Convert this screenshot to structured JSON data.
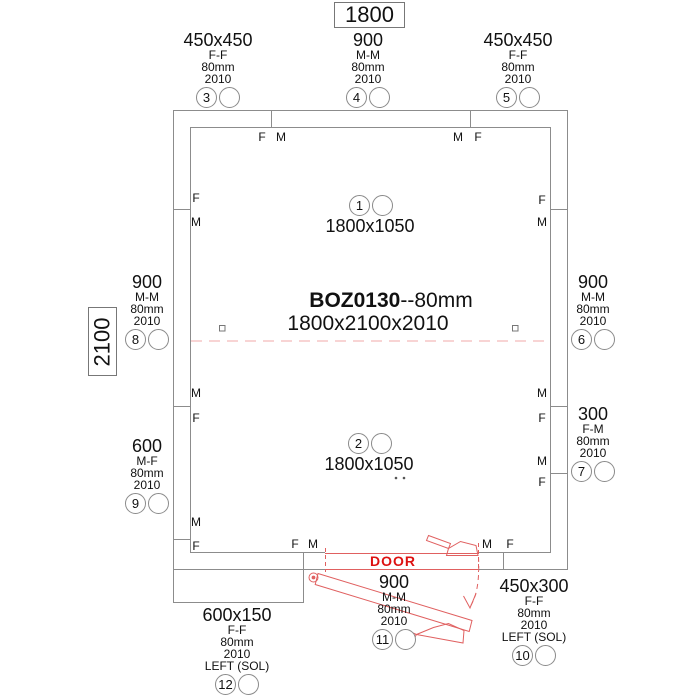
{
  "colors": {
    "line_gray": "#8c8c8c",
    "door_red": "#e06060",
    "door_text_red": "#dd1111",
    "ceiling_joint_pink": "#f2a8a8"
  },
  "title": {
    "model": "BOZ0130",
    "suffix": "--80mm",
    "box_dimensions": "1800x2100x2010"
  },
  "overall_dimensions": {
    "width": "1800",
    "height": "2100"
  },
  "door": {
    "label": "DOOR"
  },
  "ceiling_panels": [
    {
      "num": "1",
      "size": "1800x1050"
    },
    {
      "num": "2",
      "size": "1800x1050"
    }
  ],
  "panels": {
    "p3": {
      "num": "3",
      "size": "450x450",
      "joint": "F-F",
      "thickness": "80mm",
      "height": "2010"
    },
    "p4": {
      "num": "4",
      "size": "900",
      "joint": "M-M",
      "thickness": "80mm",
      "height": "2010"
    },
    "p5": {
      "num": "5",
      "size": "450x450",
      "joint": "F-F",
      "thickness": "80mm",
      "height": "2010"
    },
    "p6": {
      "num": "6",
      "size": "900",
      "joint": "M-M",
      "thickness": "80mm",
      "height": "2010"
    },
    "p7": {
      "num": "7",
      "size": "300",
      "joint": "F-M",
      "thickness": "80mm",
      "height": "2010"
    },
    "p8": {
      "num": "8",
      "size": "900",
      "joint": "M-M",
      "thickness": "80mm",
      "height": "2010"
    },
    "p9": {
      "num": "9",
      "size": "600",
      "joint": "M-F",
      "thickness": "80mm",
      "height": "2010"
    },
    "p10": {
      "num": "10",
      "size": "450x300",
      "joint": "F-F",
      "thickness": "80mm",
      "height": "2010",
      "note": "LEFT (SOL)"
    },
    "p11": {
      "num": "11",
      "size": "900",
      "joint": "M-M",
      "thickness": "80mm",
      "height": "2010"
    },
    "p12": {
      "num": "12",
      "size": "600x150",
      "joint": "F-F",
      "thickness": "80mm",
      "height": "2010",
      "note": "LEFT (SOL)"
    }
  },
  "edge_letters": {
    "top": [
      "F",
      "M",
      "M",
      "F"
    ],
    "left": [
      "F",
      "M",
      "M",
      "F",
      "M",
      "F"
    ],
    "right": [
      "F",
      "M",
      "M",
      "F",
      "M",
      "F"
    ],
    "bottom": [
      "F",
      "M",
      "M",
      "F"
    ]
  }
}
